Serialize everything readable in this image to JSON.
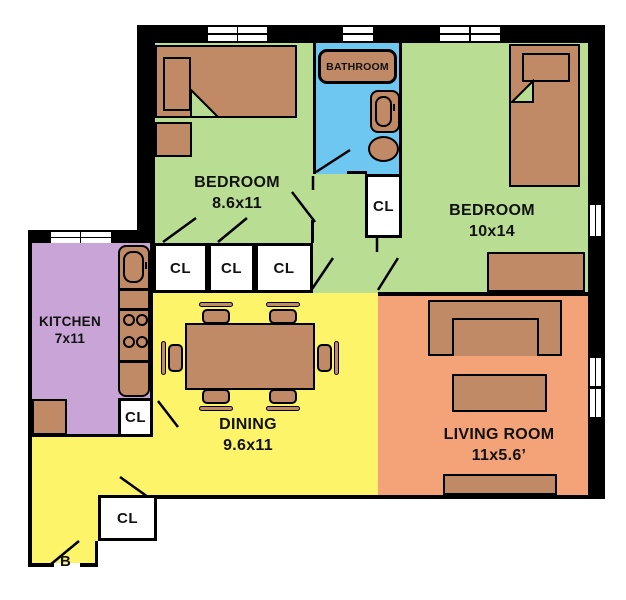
{
  "colors": {
    "bedroom": "#b9de93",
    "bathroom": "#6ec7f0",
    "kitchen": "#c8a5d6",
    "dining": "#fdf46a",
    "living": "#f4a378",
    "furniture": "#c08a66",
    "wall": "#000000"
  },
  "rooms": {
    "bedroom1": {
      "name": "BEDROOM",
      "dims": "8.6x11"
    },
    "bedroom2": {
      "name": "BEDROOM",
      "dims": "10x14"
    },
    "bathroom": {
      "name": "BATHROOM"
    },
    "kitchen": {
      "name": "KITCHEN",
      "dims": "7x11"
    },
    "dining": {
      "name": "DINING",
      "dims": "9.6x11"
    },
    "living": {
      "name": "LIVING ROOM",
      "dims": "11x5.6’"
    }
  },
  "closets": {
    "label": "CL"
  },
  "entry": {
    "label": "B"
  }
}
